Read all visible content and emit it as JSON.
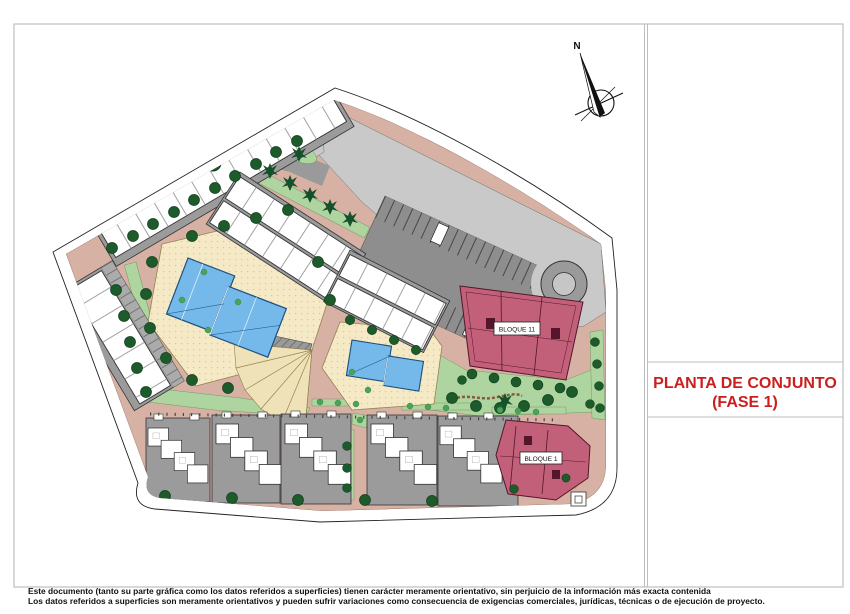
{
  "sheet": {
    "width_px": 850,
    "height_px": 614
  },
  "title_block": {
    "line1": "PLANTA DE CONJUNTO",
    "line2": "(FASE 1)",
    "color": "#cb1f1f"
  },
  "compass": {
    "north_label": "N"
  },
  "plan": {
    "block_labels": {
      "bloque_11": "BLOQUE 11",
      "bloque_1": "BLOQUE 1"
    },
    "colors": {
      "path_salmon": "#d7b2a4",
      "green_light": "#aed5a0",
      "tree_dark": "#1d5b2b",
      "deck_beige": "#f5e9c6",
      "pool_blue": "#74b9ea",
      "block_maroon": "#c2607a",
      "road_light": "#c9c9c9",
      "parking_dark": "#8e8e8e",
      "building_white": "#ffffff",
      "plot_gray": "#9b9b9b"
    }
  },
  "disclaimer": {
    "line1": "Este documento (tanto su parte gráfica como los datos referidos a superficies) tienen carácter meramente orientativo, sin perjuicio de la información más exacta contenida",
    "line2": "Los datos referidos a superficies son meramente orientativos y pueden sufrir variaciones como consecuencia de exigencias comerciales, jurídicas, técnicas o de ejecución de proyecto."
  }
}
